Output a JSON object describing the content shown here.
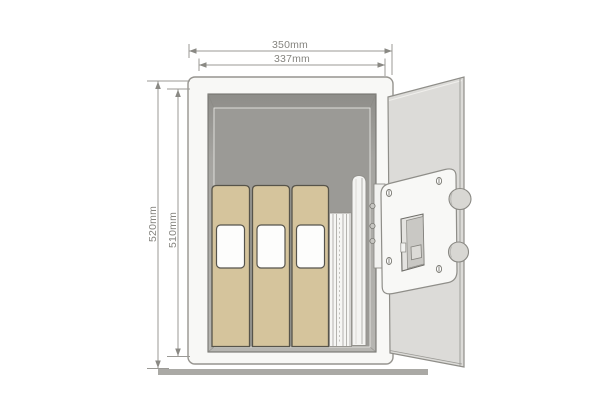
{
  "figure": {
    "type": "product-dimension-diagram",
    "subject": "security safe shown open, front view, door swung to the right",
    "dimension_labels": {
      "outer_width": "350mm",
      "inner_width": "337mm",
      "outer_height": "520mm",
      "inner_height": "510mm"
    },
    "contents": {
      "binders_count": 3,
      "items": [
        "ring-binder",
        "ring-binder",
        "ring-binder",
        "paper-stack",
        "rolled-document-tube"
      ]
    },
    "door_features": [
      "lock-housing",
      "battery-compartment",
      "locking-bolts",
      "corner-screws",
      "hinge-plate"
    ],
    "colors": {
      "background": "#ffffff",
      "safe_body": "#f8f8f6",
      "interior_back": "#9b9a96",
      "bevel_dark": "#8e8d89",
      "bevel_light": "#b7b6b2",
      "binder_tan": "#d5c49c",
      "binder_outline": "#57544a",
      "door_panel": "#dcdbd8",
      "lock_housing": "#f8f8f6",
      "knob_gray": "#d8d7d3",
      "floor_bar": "#aaa9a5",
      "dimension_line": "#9b9a96",
      "dimension_text": "#85847f"
    }
  }
}
